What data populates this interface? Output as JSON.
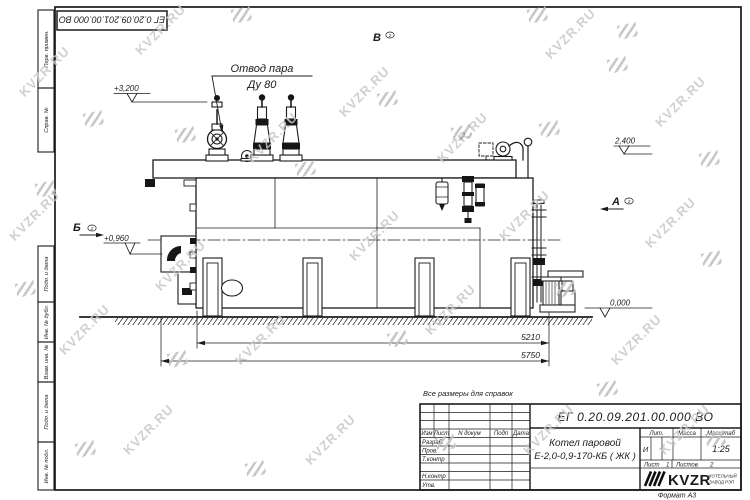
{
  "sheet": {
    "doc_number": "ЕГ 0.20.09.201.00.000  ВО",
    "format_note": "Формат А3",
    "reference_note": "Все размеры для справок"
  },
  "margin": {
    "perv_primen": "Перв. примен.",
    "sprav_no": "Справ. №",
    "podp_data_1": "Подп. и дата",
    "inv_dubl": "Инв. № дубл.",
    "vzam_inv": "Взам. инв. №",
    "podp_data_2": "Подп. и дата",
    "inv_podl": "Инв. № подл."
  },
  "title_block": {
    "doc_number": "ЕГ 0.20.09.201.00.000  ВО",
    "product_line1": "Котел паровой",
    "product_line2": "Е-2,0-0,9-170-КБ ( ЖК )",
    "col_izm": "Изм",
    "col_list": "Лист",
    "col_ndokum": "N докум",
    "col_podp": "Подп",
    "col_data": "Дата",
    "row_razrab": "Разраб.",
    "row_prov": "Пров.",
    "row_tkontr": "Т.контр",
    "row_nkontr": "Н.контр",
    "row_utv": "Утв.",
    "lit_label": "Лит.",
    "lit_value": "И",
    "massa_label": "Масса",
    "masshtab_label": "Масштаб",
    "masshtab_value": "1:25",
    "list_label": "Лист",
    "list_value": "1",
    "listov_label": "Листов",
    "listov_value": "2",
    "logo_text": "KVZR",
    "logo_sub_line1": "КОТЕЛЬНЫЙ",
    "logo_sub_line2": "ЗАВОД РЭП",
    "logo_sub_color": "#c75b28"
  },
  "drawing": {
    "callout_steam_line1": "Отвод пара",
    "callout_steam_line2": "Ду 80",
    "elevation_top": "+3,200",
    "elevation_right": "2,400",
    "elevation_burner": "+0,960",
    "elevation_ground": "0,000",
    "dim_inner": "5210",
    "dim_overall": "5750",
    "view_a": "А",
    "view_b": "Б",
    "view_v": "В",
    "view_sheet_ref": "2"
  },
  "watermark": {
    "text": "KVZR.RU",
    "color": "#c8c8c8"
  }
}
